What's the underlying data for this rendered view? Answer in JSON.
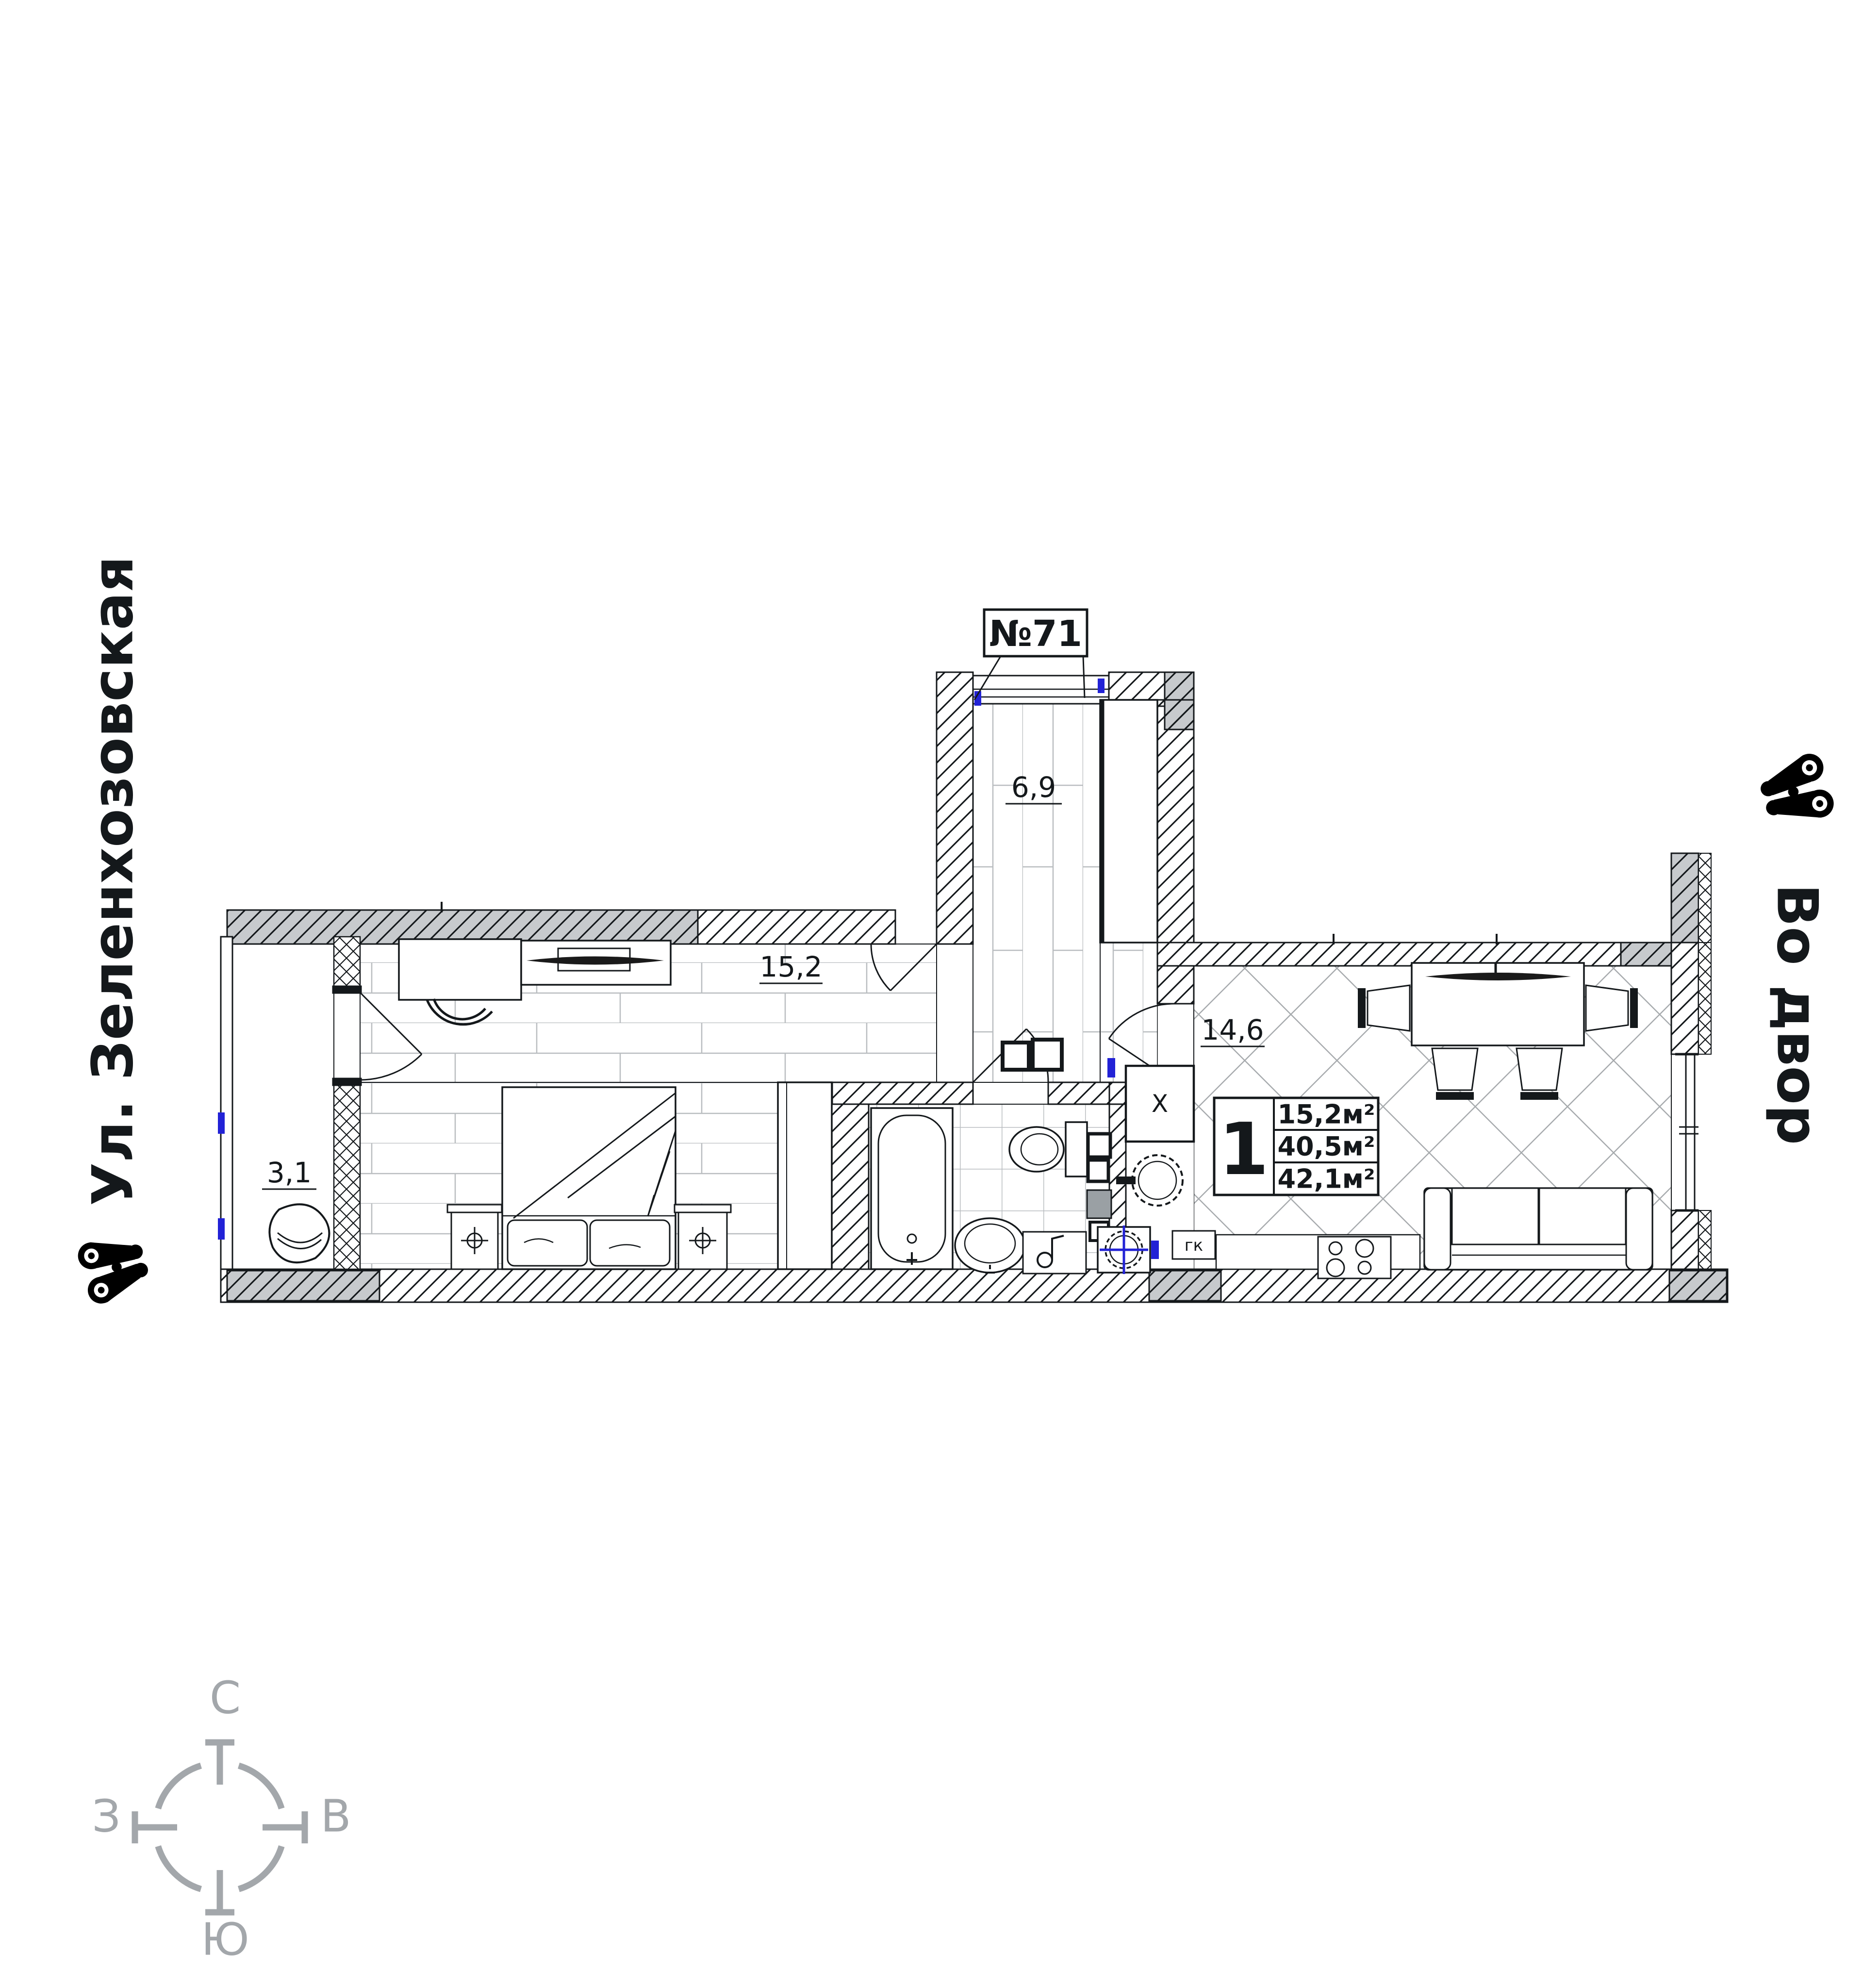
{
  "street": {
    "name": "Ул. Зеленхозовская"
  },
  "courtyard": {
    "name": "Во двор"
  },
  "apartment": {
    "number": "№71",
    "rooms": [
      {
        "key": "bedroom",
        "area": "15,2"
      },
      {
        "key": "hallway",
        "area": "6,9"
      },
      {
        "key": "kitchen_living",
        "area": "14,6"
      },
      {
        "key": "balcony",
        "area": "3,1"
      }
    ],
    "info_table": {
      "rooms_count": "1",
      "rows": [
        "15,2м²",
        "40,5м²",
        "42,1м²"
      ]
    },
    "marks": {
      "shaft": "X",
      "gas_boiler": "гк"
    }
  },
  "compass": {
    "north": "С",
    "east": "В",
    "west": "З",
    "south": "Ю"
  },
  "colors": {
    "line": "#14181b",
    "wall_gray": "#c7cacd",
    "floor_line": "#b9bdc0",
    "diamond_line": "#a7abae",
    "accent_blue": "#2222d6",
    "compass_gray": "#a3a7ab"
  }
}
